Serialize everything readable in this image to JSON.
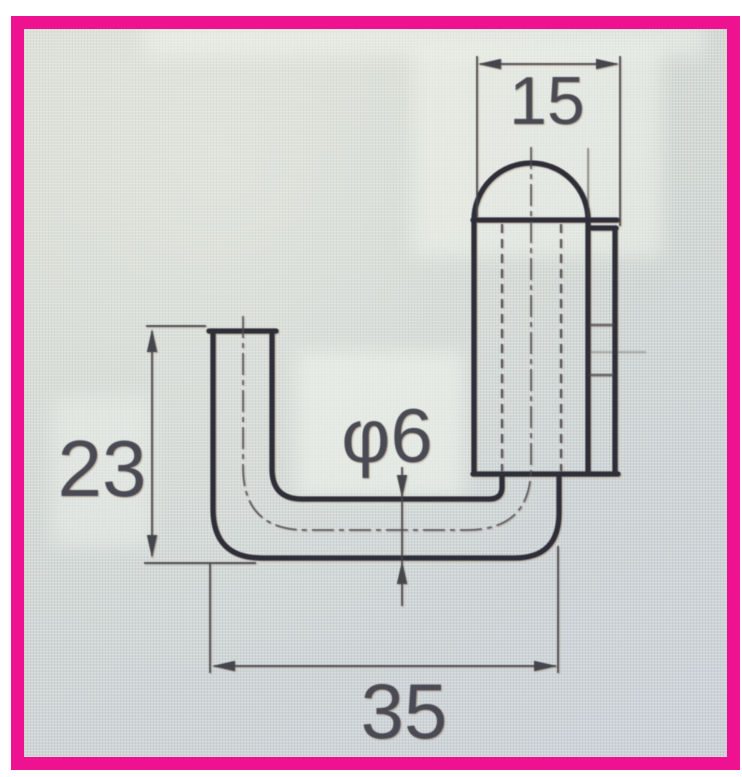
{
  "page": {
    "border_color": "#ee1190",
    "screen_bg": "#d3d8d5",
    "line_color": "#2e2e39",
    "dim_line_color": "#45454e",
    "text_color": "#4a4a54"
  },
  "drawing": {
    "kind": "engineering-drawing",
    "subject": "bent-rod hook with domed cap, front view",
    "dimensions": [
      {
        "id": "cap-width",
        "label": "15"
      },
      {
        "id": "arm-height",
        "label": "23"
      },
      {
        "id": "rod-diameter",
        "label": "φ6"
      },
      {
        "id": "base-length",
        "label": "35"
      }
    ]
  }
}
